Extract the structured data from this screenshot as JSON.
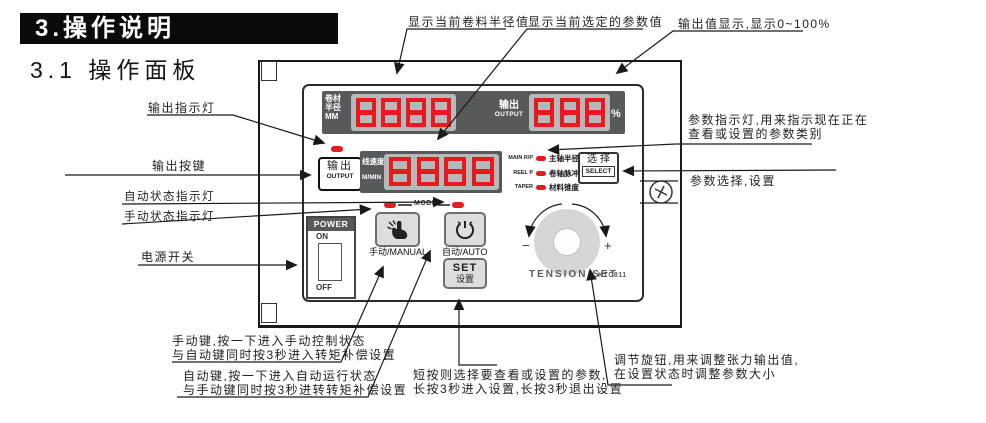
{
  "page": {
    "section_title": "3.操作说明",
    "subsection_title": "3.1 操作面板"
  },
  "callouts": {
    "roll_radius_display": "显示当前卷料半径值",
    "selected_param_display": "显示当前选定的参数值",
    "output_value_display": "输出值显示,显示0~100%",
    "output_indicator": "输出指示灯",
    "output_key": "输出按键",
    "auto_status_indicator": "自动状态指示灯",
    "manual_status_indicator": "手动状态指示灯",
    "power_switch": "电源开关",
    "param_indicator_line1": "参数指示灯,用来指示现在正在",
    "param_indicator_line2": "查看或设置的参数类别",
    "param_select": "参数选择,设置",
    "manual_key_line1": "手动键,按一下进入手动控制状态",
    "manual_key_line2": "与自动键同时按3秒进入转矩补偿设置",
    "auto_key_line1": "自动键,按一下进入自动运行状态",
    "auto_key_line2": "与手动键同时按3秒进转转矩补偿设置",
    "set_key_line1": "短按则选择要查看或设置的参数,",
    "set_key_line2": "长按3秒进入设置,长按3秒退出设置",
    "knob_line1": "调节旋钮,用来调整张力输出值,",
    "knob_line2": "在设置状态时调整参数大小"
  },
  "panel": {
    "display_radius": {
      "label_line1": "卷材",
      "label_line2": "半径",
      "unit": "MM",
      "value": "8888"
    },
    "display_output": {
      "label_zh": "输出",
      "label_en": "OUTPUT",
      "value": "888",
      "unit": "%"
    },
    "display_speed": {
      "label_zh": "线速度",
      "label_en": "M/MIN",
      "value": "8888"
    },
    "output_button": {
      "zh": "输出",
      "en": "OUTPUT"
    },
    "param_leds": [
      {
        "en": "MAIN R/P",
        "zh": "主轴半径/脉冲"
      },
      {
        "en": "REEL P",
        "zh": "卷轴脉冲"
      },
      {
        "en": "TAPER",
        "zh": "材料锥度"
      }
    ],
    "select_button": {
      "zh": "选择",
      "en": "SELECT"
    },
    "mode_label": "MODE",
    "power": {
      "title": "POWER",
      "on": "ON",
      "off": "OFF"
    },
    "manual_button_label": "手动/MANUAL",
    "auto_button_label": "自动/AUTO",
    "set_button": {
      "en": "SET",
      "zh": "设置"
    },
    "knob": {
      "minus": "−",
      "plus": "+",
      "label": "TENSION SET",
      "model": "KTC811"
    }
  },
  "colors": {
    "led_red": "#e8191f",
    "display_bg": "#58595b",
    "digit_bg": "#b7b8ba"
  }
}
